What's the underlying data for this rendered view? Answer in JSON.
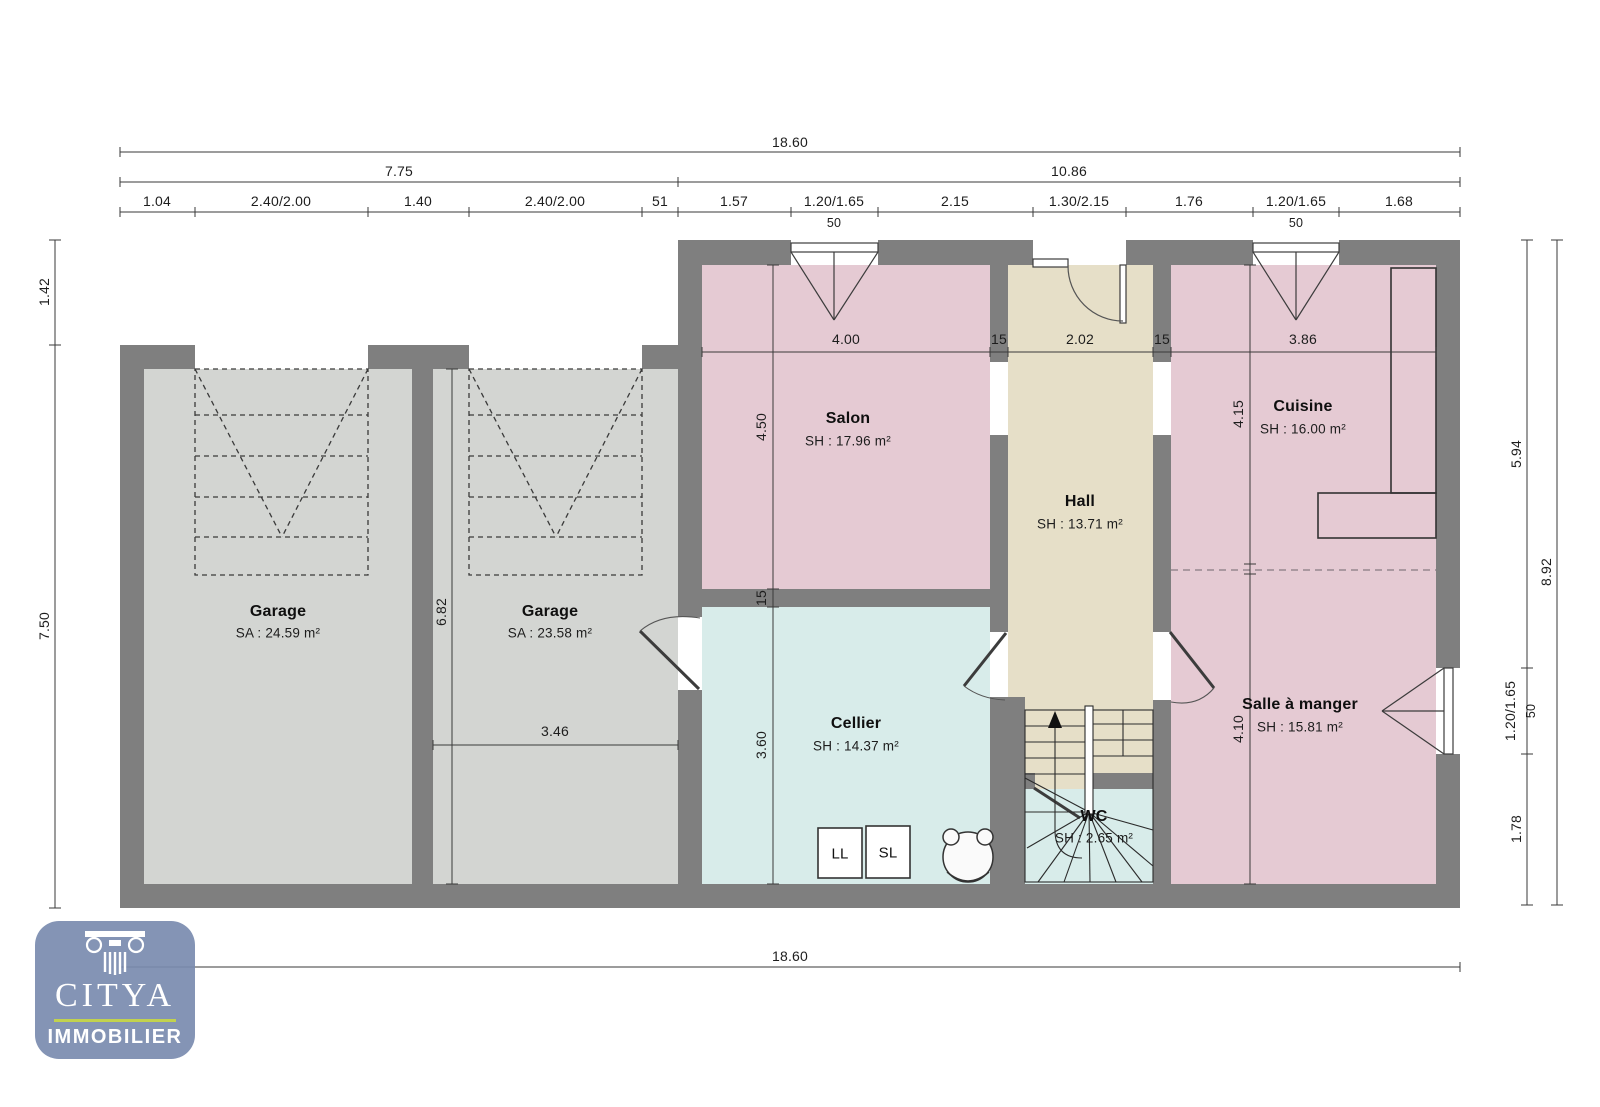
{
  "document": {
    "kind": "floor-plan"
  },
  "colors": {
    "wall": "#7f7f7f",
    "garage_fill": "#d3d5d2",
    "pink_fill": "#e5cad3",
    "hall_fill": "#e6dfc8",
    "cyan_fill": "#d8ecea",
    "logo_badge": "#7a8baf",
    "logo_rule": "#c2d24e"
  },
  "rooms": [
    {
      "name": "Garage",
      "area": "SA : 24.59 m²"
    },
    {
      "name": "Garage",
      "area": "SA : 23.58 m²"
    },
    {
      "name": "Salon",
      "area": "SH : 17.96 m²"
    },
    {
      "name": "Hall",
      "area": "SH : 13.71 m²"
    },
    {
      "name": "Cuisine",
      "area": "SH : 16.00 m²"
    },
    {
      "name": "Cellier",
      "area": "SH : 14.37 m²"
    },
    {
      "name": "Salle à manger",
      "area": "SH : 15.81 m²"
    },
    {
      "name": "WC",
      "area": "SH : 2.65 m²"
    }
  ],
  "appliances": {
    "washer": "LL",
    "dryer": "SL"
  },
  "dimensions": {
    "top_total": "18.60",
    "top_left": "7.75",
    "top_right": "10.86",
    "top_row3": [
      "1.04",
      "2.40/2.00",
      "1.40",
      "2.40/2.00",
      "51",
      "1.57",
      "1.20/1.65",
      "2.15",
      "1.30/2.15",
      "1.76",
      "1.20/1.65",
      "1.68"
    ],
    "window_sill": "50",
    "bottom_total": "18.60",
    "left": [
      "1.42",
      "7.50"
    ],
    "right_inner": [
      "5.94",
      "1.20/1.65",
      "50",
      "1.78"
    ],
    "right_outer": "8.92",
    "interior_top": [
      "4.00",
      "15",
      "2.02",
      "15",
      "3.86"
    ],
    "salon_depth": "4.50",
    "wall_15": "15",
    "cellier_depth": "3.60",
    "cuisine_depth": "4.15",
    "salle_depth": "4.10",
    "garage2_height": "6.82",
    "garage2_width": "3.46"
  },
  "logo": {
    "brand": "CITYA",
    "tagline": "IMMOBILIER"
  }
}
